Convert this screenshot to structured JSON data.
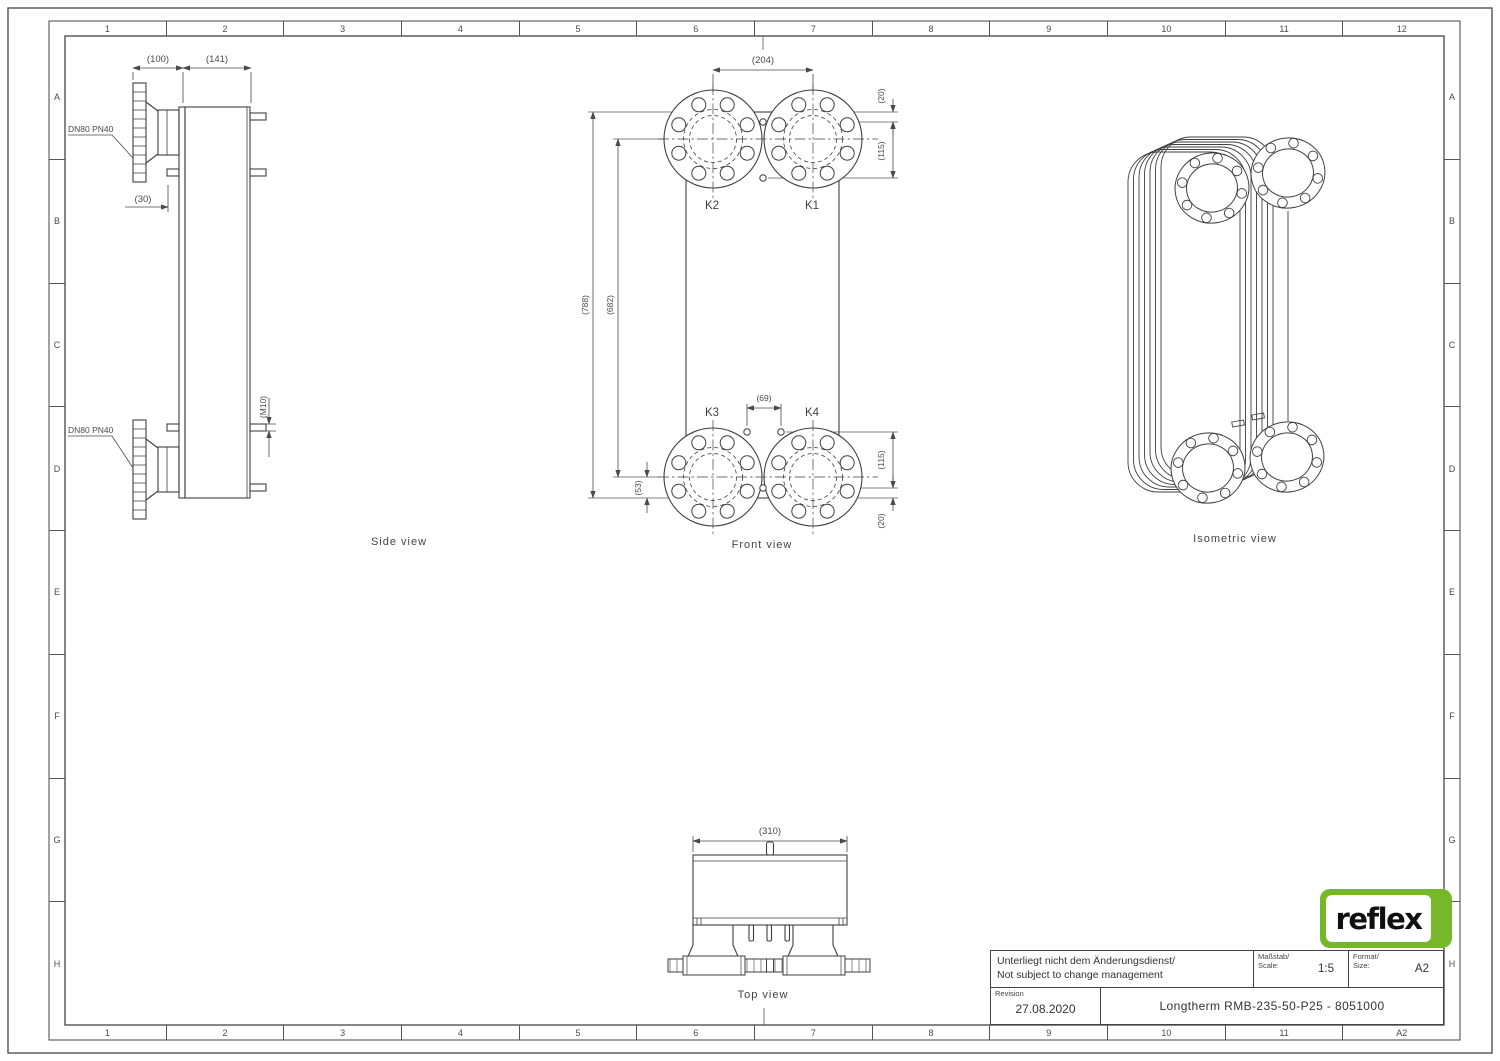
{
  "sheet": {
    "colors": {
      "line": "#3f3f3f",
      "dim": "#4a4a4a",
      "frame": "#444444",
      "logo_green": "#76b82a"
    }
  },
  "rulers": {
    "columns_top": [
      "1",
      "2",
      "3",
      "4",
      "5",
      "6",
      "7",
      "8",
      "9",
      "10",
      "11",
      "12"
    ],
    "columns_bottom": [
      "1",
      "2",
      "3",
      "4",
      "5",
      "6",
      "7",
      "8",
      "9",
      "10",
      "11",
      "A2"
    ],
    "rows_left": [
      "A",
      "B",
      "C",
      "D",
      "E",
      "F",
      "G",
      "H"
    ],
    "rows_right": [
      "A",
      "B",
      "C",
      "D",
      "E",
      "F",
      "G",
      "H"
    ]
  },
  "views": {
    "side": {
      "label": "Side view",
      "dim_100": "(100)",
      "dim_141": "(141)",
      "dim_30": "(30)",
      "dim_m10": "(M10)",
      "flange_top_label": "DN80 PN40",
      "flange_bottom_label": "DN80 PN40"
    },
    "front": {
      "label": "Front view",
      "dim_204": "(204)",
      "dim_20_top": "(20)",
      "dim_115_top": "(115)",
      "dim_788": "(788)",
      "dim_682": "(682)",
      "dim_69": "(69)",
      "dim_53": "(53)",
      "dim_115_bottom": "(115)",
      "dim_20_bottom": "(20)",
      "port_k1": "K1",
      "port_k2": "K2",
      "port_k3": "K3",
      "port_k4": "K4"
    },
    "isometric": {
      "label": "Isometric view"
    },
    "top": {
      "label": "Top view",
      "dim_310": "(310)"
    }
  },
  "title_block": {
    "note_de": "Unterliegt nicht dem Änderungsdienst/",
    "note_en": "Not subject to change management",
    "scale_label_de": "Maßstab/",
    "scale_label_en": "Scale:",
    "scale_value": "1:5",
    "format_label_de": "Format/",
    "format_label_en": "Size:",
    "format_value": "A2",
    "revision_label": "Revision",
    "revision_value": "27.08.2020",
    "drawing_title": "Longtherm RMB-235-50-P25 - 8051000"
  },
  "logo": {
    "text": "reflex"
  }
}
